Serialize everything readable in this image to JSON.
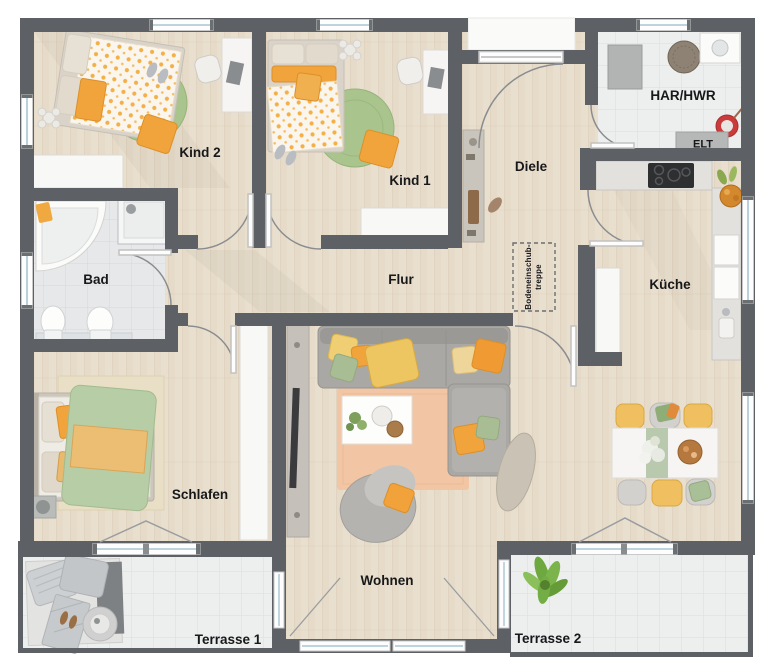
{
  "plan": {
    "rooms": {
      "kind2": "Kind 2",
      "kind1": "Kind 1",
      "diele": "Diele",
      "har": "HAR/HWR",
      "elt": "ELT",
      "bad": "Bad",
      "flur": "Flur",
      "kueche": "Küche",
      "schlafen": "Schlafen",
      "wohnen": "Wohnen",
      "terrasse1": "Terrasse 1",
      "terrasse2": "Terrasse 2",
      "attic_ladder_line1": "Bodeneinschub-",
      "attic_ladder_line2": "treppe"
    },
    "colors": {
      "wall": "#5d6165",
      "wood_floor": "#e9dfcf",
      "tile_floor": "#edeeee",
      "accent_orange": "#f2a43c",
      "accent_yellow": "#efc763",
      "rug_green": "#a9c48d",
      "duvet_green": "#b7cda6",
      "rug_peach": "#f2c6a4",
      "window_glass": "#a9c6d2",
      "bucket_red": "#cc3b3b",
      "plant_green": "#6ea93f"
    }
  }
}
